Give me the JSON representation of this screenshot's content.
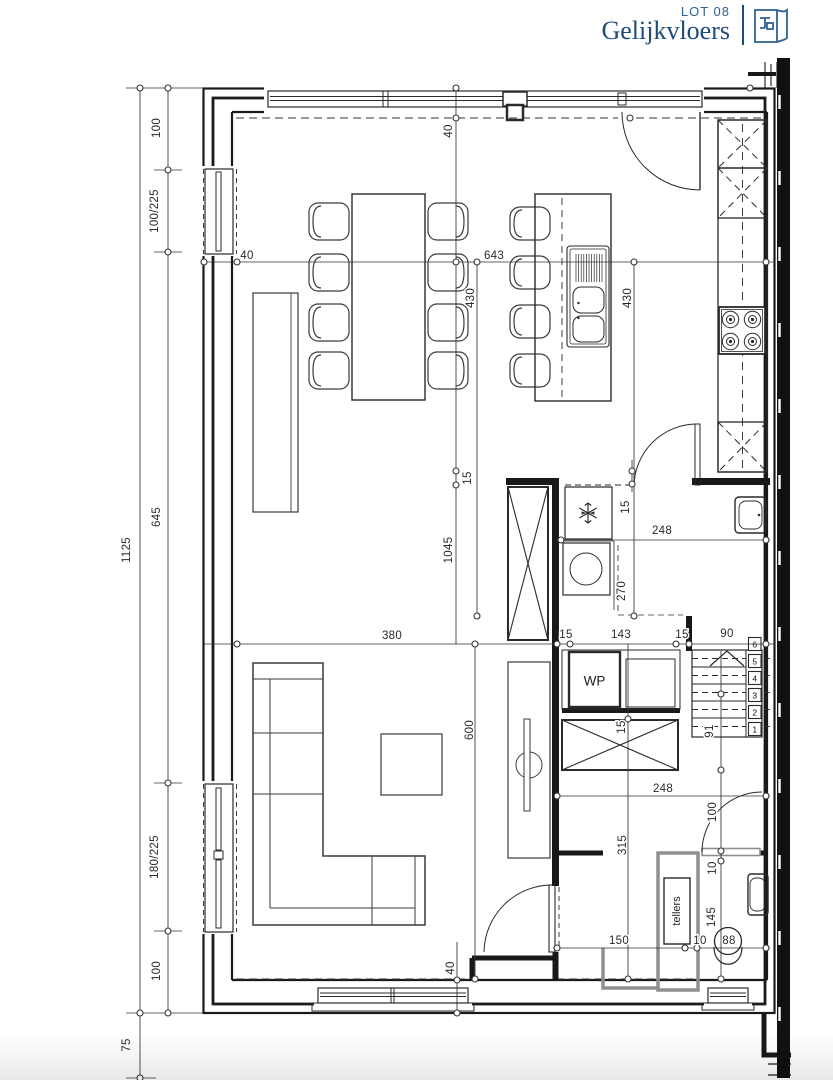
{
  "header": {
    "lot_label": "LOT 08",
    "title": "Gelijkvloers"
  },
  "palette": {
    "accent": "#1d4b7c",
    "accent_light": "#2e6095",
    "wall": "#1a1a1a",
    "dim_line": "#333333",
    "overhead_gray": "#8f8f8f"
  },
  "icons": {
    "header": "floor-plan-icon",
    "freezer": "snowflake-icon"
  },
  "plan": {
    "rooms": {
      "heat_pump_label": "WP",
      "meters_label": "tellers"
    },
    "stairs": {
      "steps": [
        "1",
        "2",
        "3",
        "4",
        "5",
        "6"
      ],
      "run_label": "91"
    },
    "dimensions": {
      "left_total": "1125",
      "left_below_plan": "75",
      "left_segments": [
        "100",
        "100/225",
        "645",
        "180/225",
        "100"
      ],
      "top_wall_depth": "40",
      "front_wall_offset": "40",
      "living_dining_width": "643",
      "island_length_left": "430",
      "island_length_right": "430",
      "open_plan_depth": "1045",
      "inner_wall_left": "15",
      "inner_wall_right": "15",
      "utility_width": "248",
      "utility_clearance": "270",
      "living_width": "380",
      "wall_seg_a": "15",
      "tech_width": "143",
      "wall_seg_b": "15",
      "stair_width": "90",
      "living_depth": "600",
      "tech_gap": "15",
      "hall_width_top": "248",
      "hall_depth": "315",
      "wc_door_clear": "100",
      "wc_gap": "10",
      "wc_depth": "145",
      "hall_width": "150",
      "hall_gap": "10",
      "wc_width": "88",
      "rear_wall_depth": "40"
    }
  }
}
